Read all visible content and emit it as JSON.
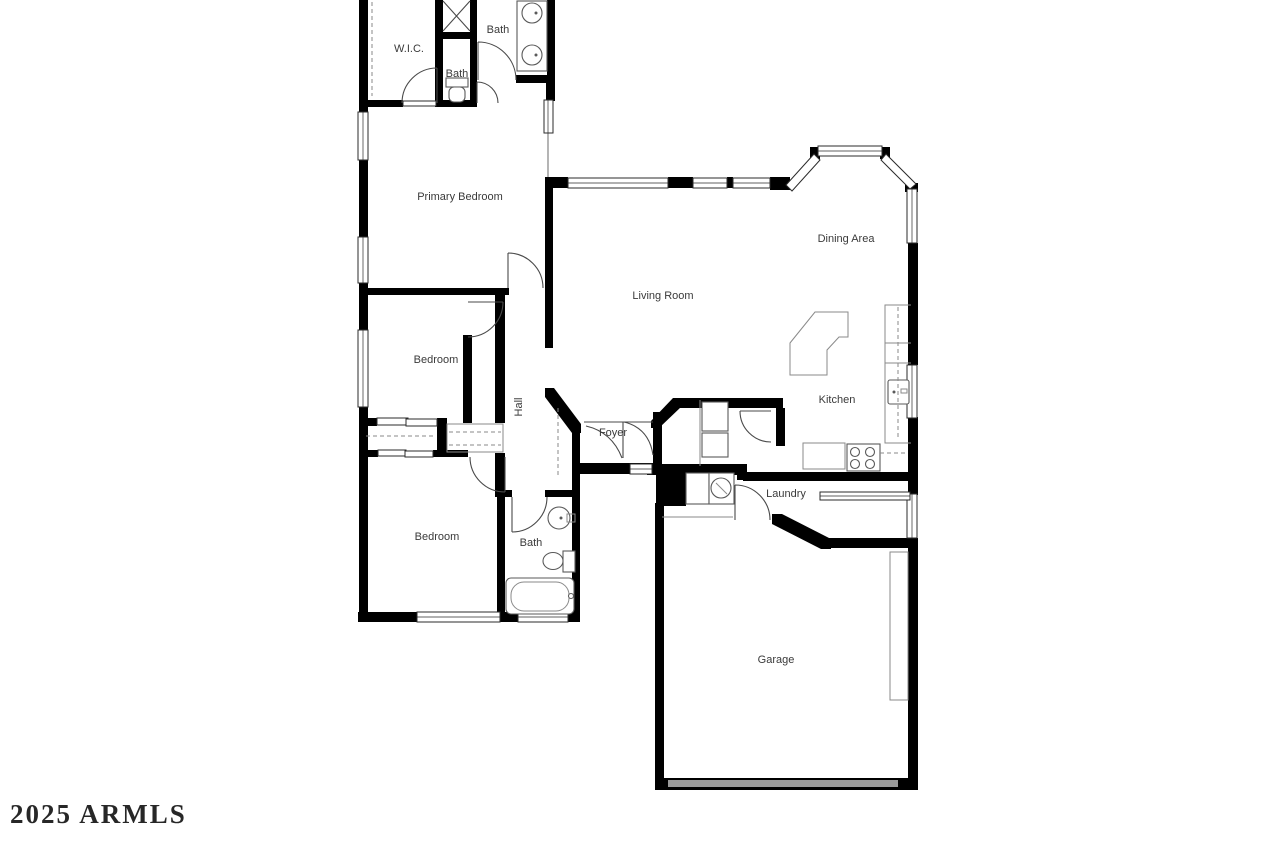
{
  "floorplan": {
    "watermark": "2025 ARMLS",
    "colors": {
      "wall": "#000000",
      "window_stroke": "#2b2b2b",
      "fixture_stroke": "#5a5a5a",
      "label": "#3a3a3a",
      "garage_door": "#9a9a9a",
      "watermark": "#101010",
      "background": "#ffffff"
    },
    "rooms": {
      "wic": {
        "label": "W.I.C."
      },
      "bath_primary": {
        "label": "Bath"
      },
      "bath_toilet": {
        "label": "Bath"
      },
      "primary_bedroom": {
        "label": "Primary Bedroom"
      },
      "bedroom_middle": {
        "label": "Bedroom"
      },
      "hall": {
        "label": "Hall"
      },
      "living_room": {
        "label": "Living Room"
      },
      "dining_area": {
        "label": "Dining Area"
      },
      "kitchen": {
        "label": "Kitchen"
      },
      "foyer": {
        "label": "Foyer"
      },
      "bedroom_lower": {
        "label": "Bedroom"
      },
      "bath_hall": {
        "label": "Bath"
      },
      "laundry": {
        "label": "Laundry"
      },
      "garage": {
        "label": "Garage"
      }
    }
  }
}
